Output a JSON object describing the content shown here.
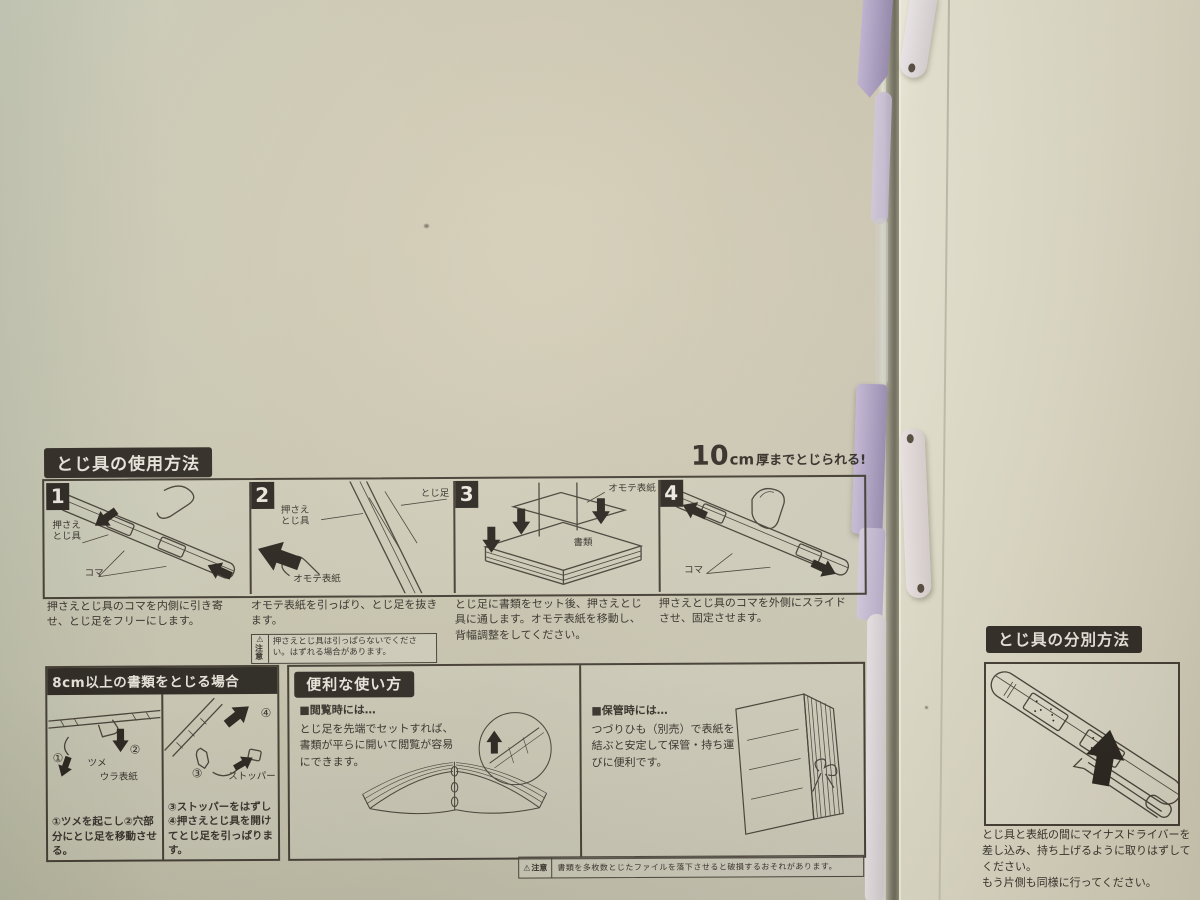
{
  "colors": {
    "folder_green": "#cfccb8",
    "cream_page": "#e8e4d2",
    "clip_purple": "#b4a7ca",
    "strap_white": "#eae4e6",
    "ink": "#39332c"
  },
  "usage": {
    "title": "とじ具の使用方法",
    "capacity": {
      "big": "10",
      "unit": "cm",
      "rest": "厚までとじられる!"
    },
    "steps": [
      {
        "num": "1",
        "caption": "押さえとじ具のコマを内側に引き寄せ、とじ足をフリーにします。",
        "labels": {
          "osae": "押さえ\nとじ具",
          "koma": "コマ"
        }
      },
      {
        "num": "2",
        "caption": "オモテ表紙を引っぱり、とじ足を抜きます。",
        "labels": {
          "tojiashi": "とじ足",
          "osae": "押さえ\nとじ具",
          "omote": "オモテ表紙"
        },
        "warning": {
          "icon": "⚠",
          "label": "注意",
          "text": "押さえとじ具は引っぱらないでください。はずれる場合があります。"
        }
      },
      {
        "num": "3",
        "caption": "とじ足に書類をセット後、押さえとじ具に通します。オモテ表紙を移動し、背幅調整をしてください。",
        "labels": {
          "omote": "オモテ表紙",
          "shorui": "書類"
        }
      },
      {
        "num": "4",
        "caption": "押さえとじ具のコマを外側にスライドさせ、固定させます。",
        "labels": {
          "koma": "コマ"
        }
      }
    ]
  },
  "thick": {
    "title": "8cm以上の書類をとじる場合",
    "left": {
      "step1": "①",
      "tsume": "ツメ",
      "step2": "②",
      "ura": "ウラ表紙",
      "caption": "①ツメを起こし②穴部分にとじ足を移動させる。"
    },
    "right": {
      "step4": "④",
      "step3": "③",
      "stopper": "ストッパー",
      "caption": "③ストッパーをはずし④押さえとじ具を開けてとじ足を引っぱります。"
    }
  },
  "handy": {
    "title": "便利な使い方",
    "browse": {
      "heading": "■閲覧時には…",
      "body": "とじ足を先端でセットすれば、書類が平らに開いて閲覧が容易にできます。"
    },
    "store": {
      "heading": "■保管時には…",
      "body": "つづりひも（別売）で表紙を結ぶと安定して保管・持ち運びに便利です。"
    }
  },
  "footer_warning": {
    "icon": "⚠",
    "label": "注意",
    "text": "書類を多枚数とじたファイルを落下させると破損するおそれがあります。"
  },
  "separation": {
    "title": "とじ具の分別方法",
    "caption": "とじ具と表紙の間にマイナスドライバーを差し込み、持ち上げるように取りはずしてください。\nもう片側も同様に行ってください。"
  }
}
